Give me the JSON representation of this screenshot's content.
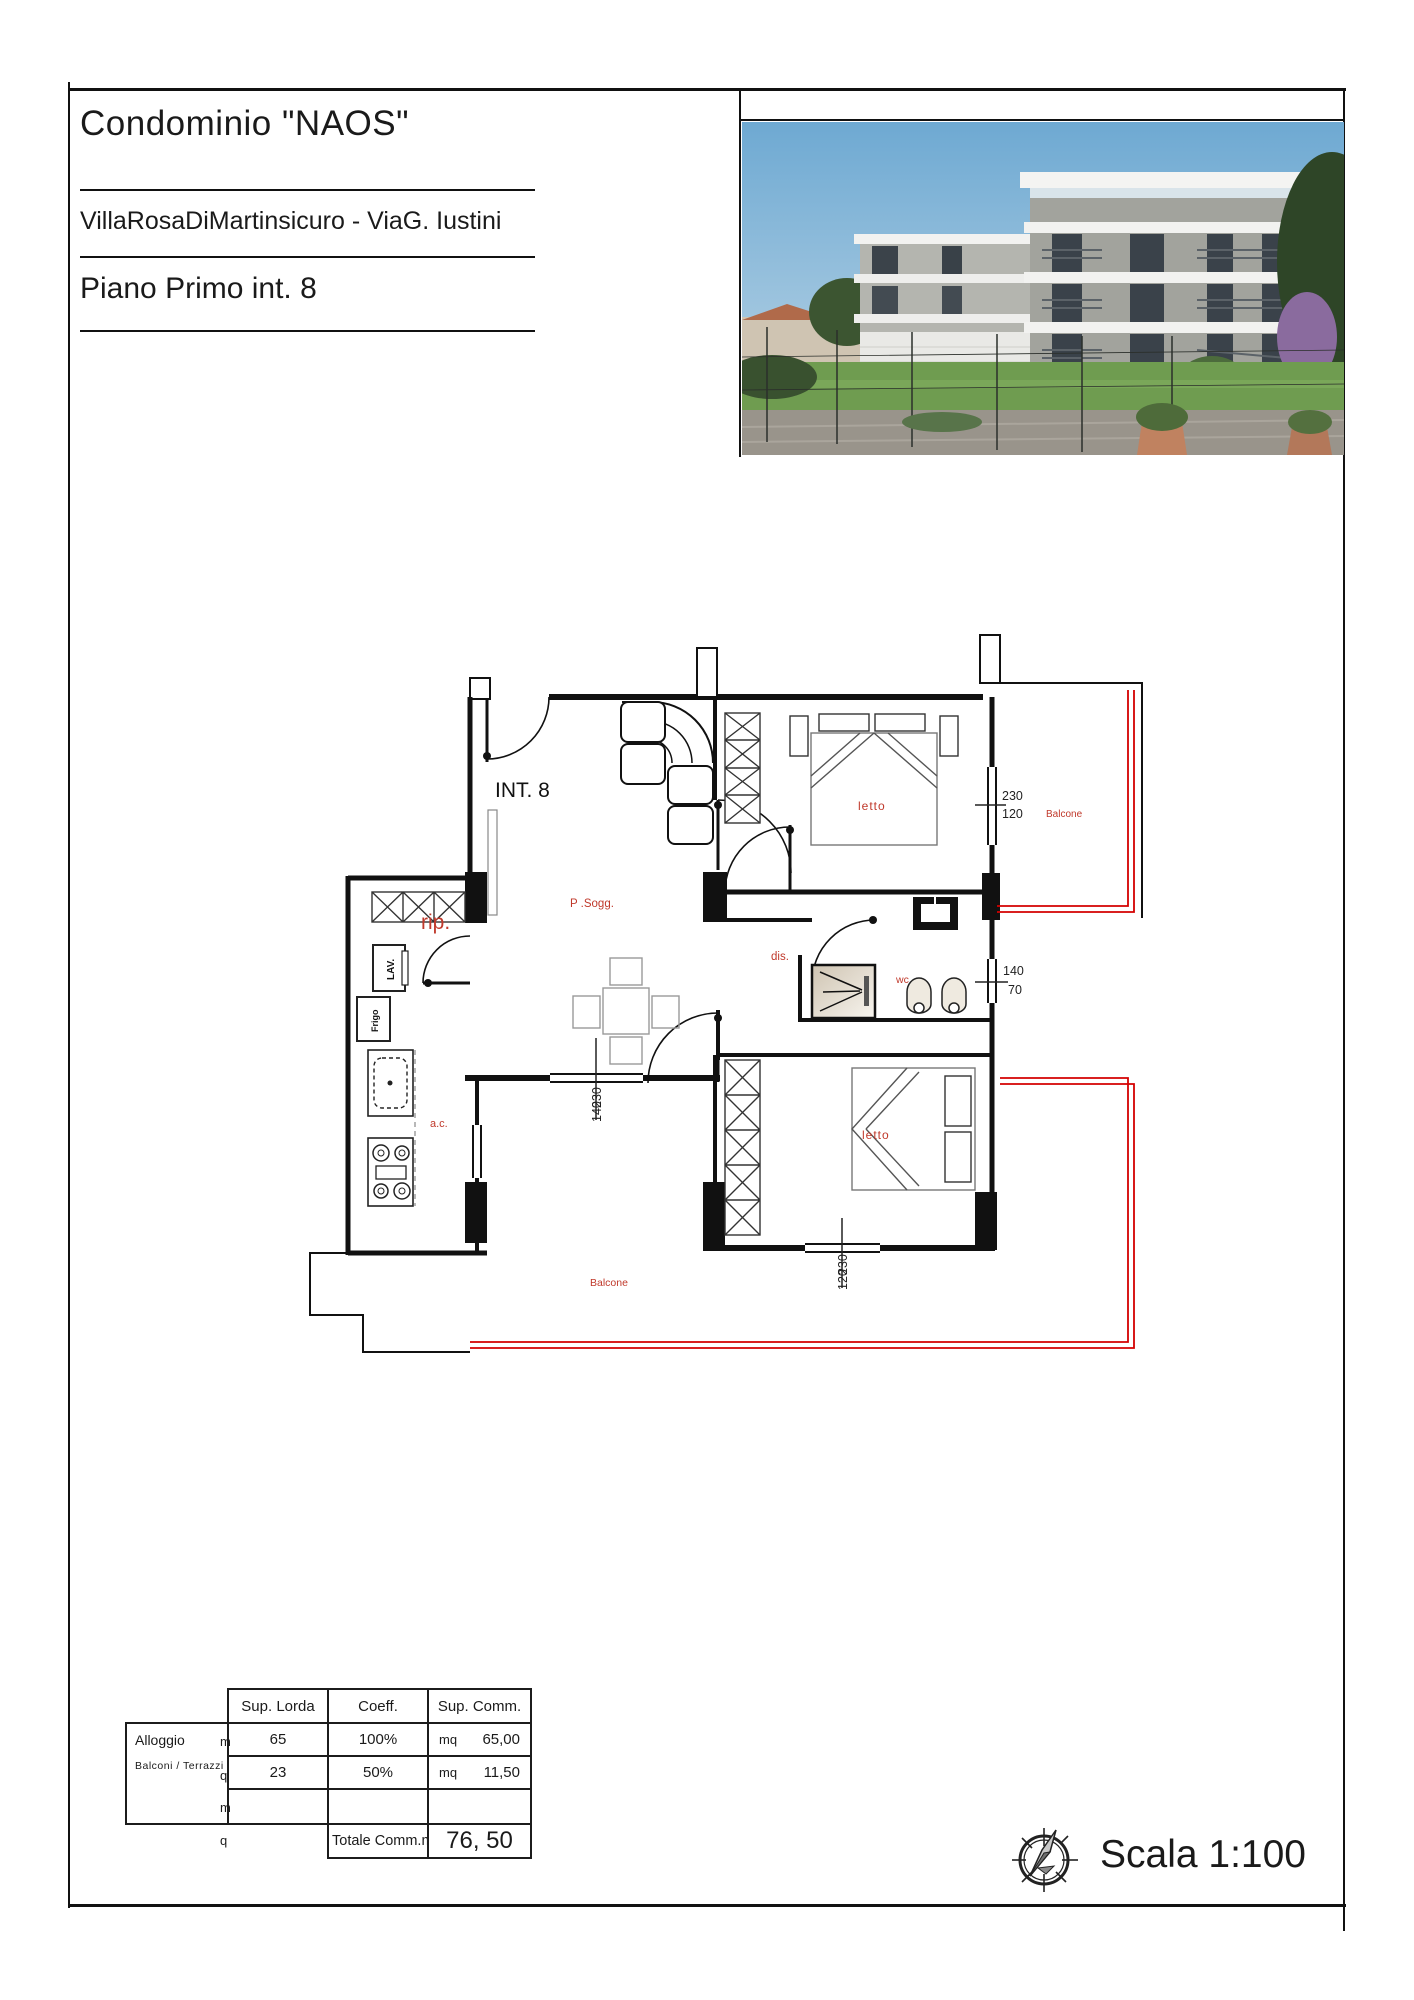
{
  "title_block": {
    "title": "Condominio \"NAOS\"",
    "address": "VillaRosaDiMartinsicuro - ViaG. Iustini",
    "floor": "Piano Primo int. 8"
  },
  "photo": {
    "description": "building-exterior-rendering"
  },
  "plan": {
    "unit_label": "INT. 8",
    "labels": {
      "living": "P .Sogg.",
      "storage": "rip.",
      "hall": "dis.",
      "wc": "wc",
      "bedroom_top": "letto",
      "bedroom_bottom": "letto",
      "kitchen": "a.c.",
      "balcony_right": "Balcone",
      "balcony_bottom": "Balcone",
      "washer": "LAV.",
      "fridge": "Frigo"
    },
    "dimensions": {
      "win_top_right": [
        "230",
        "120"
      ],
      "win_mid_right": [
        "140",
        "70"
      ],
      "win_living": [
        "140",
        "230"
      ],
      "win_bedroom2": [
        "120",
        "230"
      ]
    }
  },
  "table": {
    "headers": [
      "Sup. Lorda",
      "Coeff.",
      "Sup. Comm."
    ],
    "rows": [
      {
        "label": "Alloggio",
        "lorda": "65",
        "coeff": "100%",
        "comm_unit": "mq",
        "comm_value": "65,00"
      },
      {
        "label": "Balconi / Terrazzi",
        "lorda": "23",
        "coeff": "50%",
        "comm_unit": "mq",
        "comm_value": "11,50"
      }
    ],
    "unit_letters": [
      "m",
      "q",
      "m",
      "q"
    ],
    "total_label": "Totale Comm.mq",
    "total_value": "76, 50"
  },
  "footer": {
    "scale_label": "Scala 1:100"
  },
  "colors": {
    "annotation": "#c0392b",
    "balcony_line": "#d40000",
    "wall": "#111111"
  }
}
